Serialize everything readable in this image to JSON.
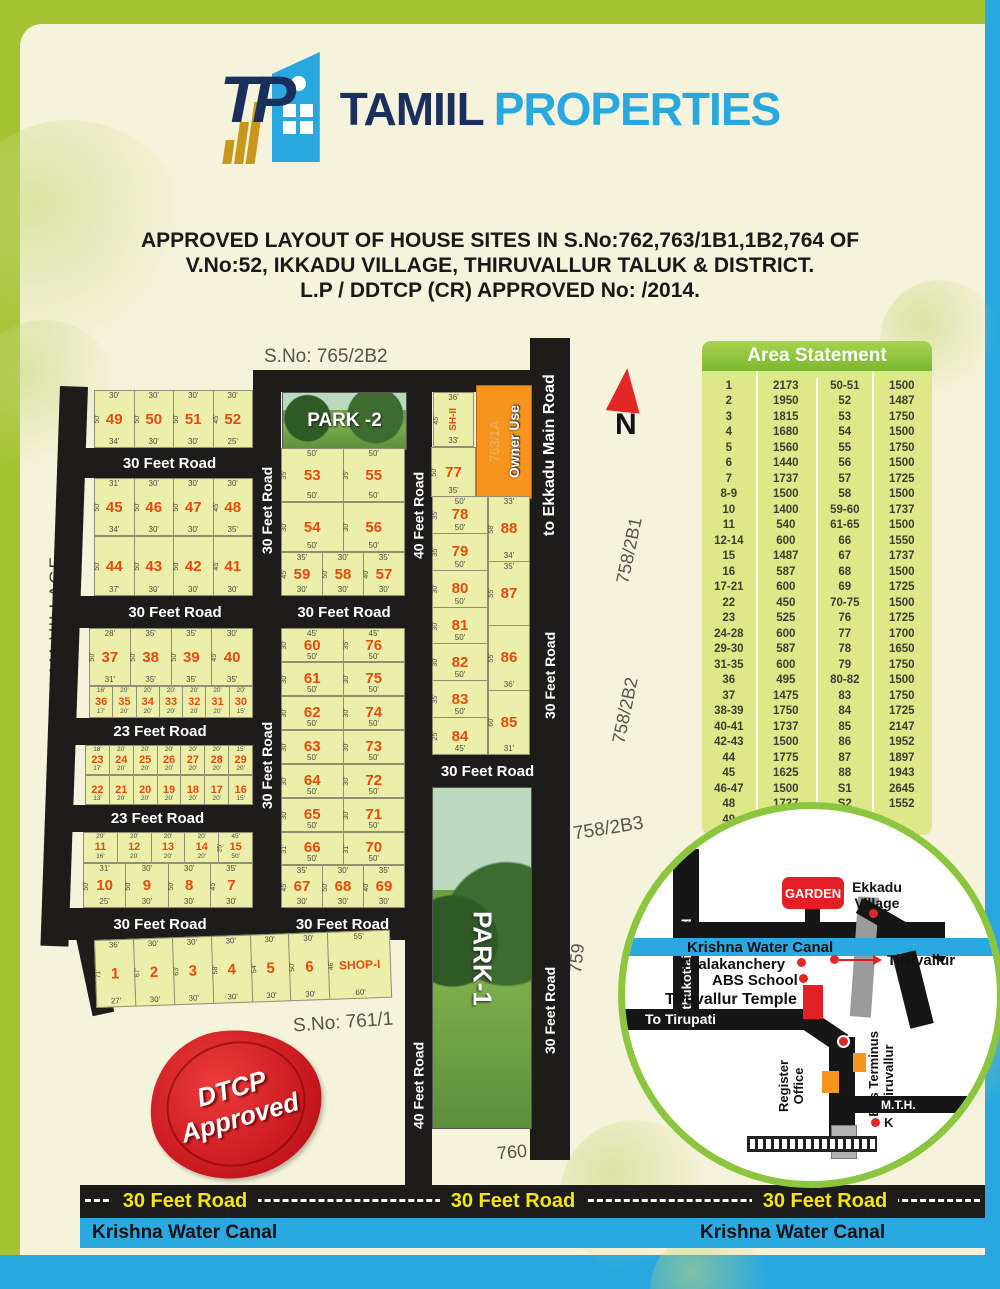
{
  "colors": {
    "frame_green": "#A6C334",
    "accent_blue": "#29A8E0",
    "navy": "#1B2F5E",
    "plot_fill": "#ECEFA9",
    "road_black": "#1d1c1a",
    "plot_number_red": "#E84A0C",
    "owner_orange": "#F7941D",
    "stamp_red": "#C5161D",
    "canal_blue": "#2AA9E1",
    "road_text_yellow": "#F4E613",
    "table_green": "#7CB82F",
    "table_body": "#DEE888"
  },
  "logo": {
    "icon_letters": "TP",
    "name_primary": "TAMIIL",
    "name_secondary": "PROPERTIES"
  },
  "title": {
    "line1": "APPROVED LAYOUT OF HOUSE SITES IN S.No:762,763/1B1,1B2,764 OF",
    "line2": "V.No:52, IKKADU VILLAGE, THIRUVALLUR TALUK & DISTRICT.",
    "line3": "L.P / DDTCP (CR) APPROVED No:   /2014."
  },
  "area_statement": {
    "title": "Area Statement",
    "left": [
      [
        "1",
        "2173"
      ],
      [
        "2",
        "1950"
      ],
      [
        "3",
        "1815"
      ],
      [
        "4",
        "1680"
      ],
      [
        "5",
        "1560"
      ],
      [
        "6",
        "1440"
      ],
      [
        "7",
        "1737"
      ],
      [
        "8-9",
        "1500"
      ],
      [
        "10",
        "1400"
      ],
      [
        "11",
        "540"
      ],
      [
        "12-14",
        "600"
      ],
      [
        "15",
        "1487"
      ],
      [
        "16",
        "587"
      ],
      [
        "17-21",
        "600"
      ],
      [
        "22",
        "450"
      ],
      [
        "23",
        "525"
      ],
      [
        "24-28",
        "600"
      ],
      [
        "29-30",
        "587"
      ],
      [
        "31-35",
        "600"
      ],
      [
        "36",
        "495"
      ],
      [
        "37",
        "1475"
      ],
      [
        "38-39",
        "1750"
      ],
      [
        "40-41",
        "1737"
      ],
      [
        "42-43",
        "1500"
      ],
      [
        "44",
        "1775"
      ],
      [
        "45",
        "1625"
      ],
      [
        "46-47",
        "1500"
      ],
      [
        "48",
        "1737"
      ],
      [
        "49",
        "1600"
      ]
    ],
    "right": [
      [
        "50-51",
        "1500"
      ],
      [
        "52",
        "1487"
      ],
      [
        "53",
        "1750"
      ],
      [
        "54",
        "1500"
      ],
      [
        "55",
        "1750"
      ],
      [
        "56",
        "1500"
      ],
      [
        "57",
        "1725"
      ],
      [
        "58",
        "1500"
      ],
      [
        "59-60",
        "1737"
      ],
      [
        "61-65",
        "1500"
      ],
      [
        "66",
        "1550"
      ],
      [
        "67",
        "1737"
      ],
      [
        "68",
        "1500"
      ],
      [
        "69",
        "1725"
      ],
      [
        "70-75",
        "1500"
      ],
      [
        "76",
        "1725"
      ],
      [
        "77",
        "1700"
      ],
      [
        "78",
        "1650"
      ],
      [
        "79",
        "1750"
      ],
      [
        "80-82",
        "1500"
      ],
      [
        "83",
        "1750"
      ],
      [
        "84",
        "1725"
      ],
      [
        "85",
        "2147"
      ],
      [
        "86",
        "1952"
      ],
      [
        "87",
        "1897"
      ],
      [
        "88",
        "1943"
      ],
      [
        "S1",
        "2645"
      ],
      [
        "S2",
        "1552"
      ]
    ]
  },
  "map": {
    "sno_top": "S.No: 765/2B2",
    "sno_bottom": "S.No: 761/1",
    "village": "IVELLIAGARAM VILLAGE",
    "north": "N",
    "park1": "PARK-1",
    "park2": "PARK -2",
    "owner_use": "Owner Use",
    "owner_use_sub": "763/1A",
    "road30": "30 Feet Road",
    "road23": "23 Feet Road",
    "road40": "40 Feet Road",
    "ekkadu_road": "to Ekkadu Main Road",
    "s758_2b1": "758/2B1",
    "s758_2b2": "758/2B2",
    "s758_2b3": "758/2B3",
    "s759": "759",
    "s760": "760",
    "rows_left": [
      [
        {
          "n": "49",
          "t": "30'",
          "s": "50'",
          "b": "34'"
        },
        {
          "n": "50",
          "t": "30'",
          "s": "50'",
          "b": "30'"
        },
        {
          "n": "51",
          "t": "30'",
          "s": "50'",
          "b": "30'"
        },
        {
          "n": "52",
          "t": "30'",
          "s": "45'",
          "b": "25'"
        }
      ],
      [
        {
          "n": "45",
          "t": "31'",
          "s": "50'",
          "b": "34'"
        },
        {
          "n": "46",
          "t": "30'",
          "s": "50'",
          "b": "30'"
        },
        {
          "n": "47",
          "t": "30'",
          "s": "50'",
          "b": "30'"
        },
        {
          "n": "48",
          "t": "30'",
          "s": "45'",
          "b": "35'"
        }
      ],
      [
        {
          "n": "44",
          "t": "",
          "s": "50'",
          "b": "37'"
        },
        {
          "n": "43",
          "t": "",
          "s": "50'",
          "b": "30'"
        },
        {
          "n": "42",
          "t": "",
          "s": "50'",
          "b": "30'"
        },
        {
          "n": "41",
          "t": "",
          "s": "45'",
          "b": "30'"
        }
      ],
      [
        {
          "n": "37",
          "t": "28'",
          "s": "50'",
          "b": "31'"
        },
        {
          "n": "38",
          "t": "35'",
          "s": "50'",
          "b": "35'"
        },
        {
          "n": "39",
          "t": "35'",
          "s": "50'",
          "b": "35'"
        },
        {
          "n": "40",
          "t": "30'",
          "s": "45'",
          "b": "35'"
        }
      ],
      [
        {
          "n": "36",
          "t": "16'",
          "b": "17'"
        },
        {
          "n": "35",
          "t": "20'",
          "b": "20'"
        },
        {
          "n": "34",
          "t": "20'",
          "b": "20'"
        },
        {
          "n": "33",
          "t": "20'",
          "b": "20'"
        },
        {
          "n": "32",
          "t": "20'",
          "b": "20'"
        },
        {
          "n": "31",
          "t": "20'",
          "b": "20'"
        },
        {
          "n": "30",
          "t": "20'",
          "b": "15'"
        }
      ],
      [
        {
          "n": "23",
          "t": "18'",
          "b": "17'"
        },
        {
          "n": "24",
          "t": "20'",
          "b": "20'"
        },
        {
          "n": "25",
          "t": "20'",
          "b": "20'"
        },
        {
          "n": "26",
          "t": "20'",
          "b": "20'"
        },
        {
          "n": "27",
          "t": "20'",
          "b": "20'"
        },
        {
          "n": "28",
          "t": "20'",
          "b": "20'"
        },
        {
          "n": "29",
          "t": "15'",
          "b": "20'"
        }
      ],
      [
        {
          "n": "22",
          "t": "",
          "b": "13'"
        },
        {
          "n": "21",
          "t": "",
          "b": "20'"
        },
        {
          "n": "20",
          "t": "",
          "b": "20'"
        },
        {
          "n": "19",
          "t": "",
          "b": "20'"
        },
        {
          "n": "18",
          "t": "",
          "b": "20'"
        },
        {
          "n": "17",
          "t": "",
          "b": "20'"
        },
        {
          "n": "16",
          "t": "",
          "b": "15'"
        }
      ],
      [
        {
          "n": "11",
          "t": "20'",
          "b": "16'"
        },
        {
          "n": "12",
          "t": "20'",
          "b": "20'"
        },
        {
          "n": "13",
          "t": "20'",
          "b": "20'"
        },
        {
          "n": "14",
          "t": "20'",
          "b": "20'"
        },
        {
          "n": "15",
          "t": "45'",
          "s": "25'",
          "b": "50'"
        }
      ],
      [
        {
          "n": "10",
          "t": "31'",
          "s": "50'",
          "b": "25'"
        },
        {
          "n": "9",
          "t": "30'",
          "s": "50'",
          "b": "30'"
        },
        {
          "n": "8",
          "t": "30'",
          "s": "50'",
          "b": "30'"
        },
        {
          "n": "7",
          "t": "35'",
          "s": "45'",
          "b": "30'"
        }
      ],
      [
        {
          "n": "1",
          "t": "36'",
          "s": "71'",
          "b": "27'"
        },
        {
          "n": "2",
          "t": "30'",
          "s": "67'",
          "b": "30'"
        },
        {
          "n": "3",
          "t": "30'",
          "s": "63'",
          "b": "30'"
        },
        {
          "n": "4",
          "t": "30'",
          "s": "58'",
          "b": "30'"
        },
        {
          "n": "5",
          "t": "30'",
          "s": "54'",
          "b": "30'"
        },
        {
          "n": "6",
          "t": "30'",
          "s": "50'",
          "b": "30'"
        },
        {
          "n": "SHOP-I",
          "t": "55'",
          "s": "46'",
          "b": "60'",
          "shop": true
        }
      ]
    ],
    "rows_center": [
      [
        {
          "n": "53",
          "t": "50'",
          "s": "35'",
          "b": "50'"
        },
        {
          "n": "55",
          "t": "50'",
          "s": "35'",
          "b": "50'"
        }
      ],
      [
        {
          "n": "54",
          "t": "",
          "s": "30'",
          "b": "50'"
        },
        {
          "n": "56",
          "t": "",
          "s": "30'",
          "b": "50'"
        }
      ],
      [
        {
          "n": "59",
          "t": "35'",
          "s": "45'",
          "b": "30'"
        },
        {
          "n": "58",
          "t": "30'",
          "s": "50'",
          "b": "30'"
        },
        {
          "n": "57",
          "t": "35'",
          "s": "40'",
          "b": "30'"
        }
      ],
      [
        {
          "n": "60",
          "t": "45'",
          "s": "30'",
          "b": "50'"
        },
        {
          "n": "76",
          "t": "45'",
          "s": "35'",
          "b": "50'"
        }
      ],
      [
        {
          "n": "61",
          "t": "",
          "s": "30'",
          "b": "50'"
        },
        {
          "n": "75",
          "t": "",
          "s": "30'",
          "b": "50'"
        }
      ],
      [
        {
          "n": "62",
          "t": "",
          "s": "30'",
          "b": "50'"
        },
        {
          "n": "74",
          "t": "",
          "s": "30'",
          "b": "50'"
        }
      ],
      [
        {
          "n": "63",
          "t": "",
          "s": "30'",
          "b": "50'"
        },
        {
          "n": "73",
          "t": "",
          "s": "30'",
          "b": "50'"
        }
      ],
      [
        {
          "n": "64",
          "t": "",
          "s": "30'",
          "b": "50'"
        },
        {
          "n": "72",
          "t": "",
          "s": "30'",
          "b": "50'"
        }
      ],
      [
        {
          "n": "65",
          "t": "",
          "s": "30'",
          "b": "50'"
        },
        {
          "n": "71",
          "t": "",
          "s": "30'",
          "b": "50'"
        }
      ],
      [
        {
          "n": "66",
          "t": "",
          "s": "31'",
          "b": "50'"
        },
        {
          "n": "70",
          "t": "",
          "s": "31'",
          "b": "50'"
        }
      ],
      [
        {
          "n": "67",
          "t": "35'",
          "s": "45'",
          "b": "30'"
        },
        {
          "n": "68",
          "t": "30'",
          "s": "50'",
          "b": "30'"
        },
        {
          "n": "69",
          "t": "35'",
          "s": "40'",
          "b": "30'"
        }
      ]
    ],
    "sh2": [
      {
        "n": "SH-II",
        "t": "36'",
        "s": "45'",
        "b": "33'",
        "sh": true
      }
    ],
    "plot77": [
      {
        "n": "77",
        "t": "",
        "s": "50'",
        "b": "35'"
      }
    ],
    "col_right_a": [
      {
        "n": "78",
        "t": "50'",
        "s": "35'",
        "b": "50'"
      },
      {
        "n": "79",
        "t": "",
        "s": "35'",
        "b": "50'"
      },
      {
        "n": "80",
        "t": "",
        "s": "30'",
        "b": "50'"
      },
      {
        "n": "81",
        "t": "",
        "s": "30'",
        "b": "50'"
      },
      {
        "n": "82",
        "t": "",
        "s": "30'",
        "b": "50'"
      },
      {
        "n": "83",
        "t": "",
        "s": "35'",
        "b": "50'"
      },
      {
        "n": "84",
        "t": "",
        "s": "25'",
        "b": "45'"
      }
    ],
    "col_right_b": [
      {
        "n": "88",
        "t": "33'",
        "s": "58'",
        "b": "34'"
      },
      {
        "n": "87",
        "t": "35'",
        "s": "55'",
        "b": ""
      },
      {
        "n": "86",
        "t": "",
        "s": "55'",
        "b": "36'"
      },
      {
        "n": "85",
        "t": "",
        "s": "60'",
        "b": "31'"
      }
    ]
  },
  "stamp": {
    "line1": "DTCP",
    "line2": "Approved"
  },
  "locmap": {
    "garden": "GARDEN",
    "ekkadu_village": "Ekkadu Village",
    "canal": "Krishna Water Canal",
    "thalakanchery": "Thalakanchery",
    "abs_school": "ABS School",
    "temple": "Tiruvallur Temple",
    "to_tirupati": "To Tirupati",
    "tiruvallur": "Tiruvallur",
    "uthukottai": "Uthukottai Road",
    "register_office": "Register Office",
    "bus_terminus": "Bus Terminus Tiruvallur",
    "mth": "M.T.H.",
    "k": "K"
  },
  "bottom": {
    "road_label": "30 Feet Road",
    "canal_label": "Krishna Water Canal"
  }
}
